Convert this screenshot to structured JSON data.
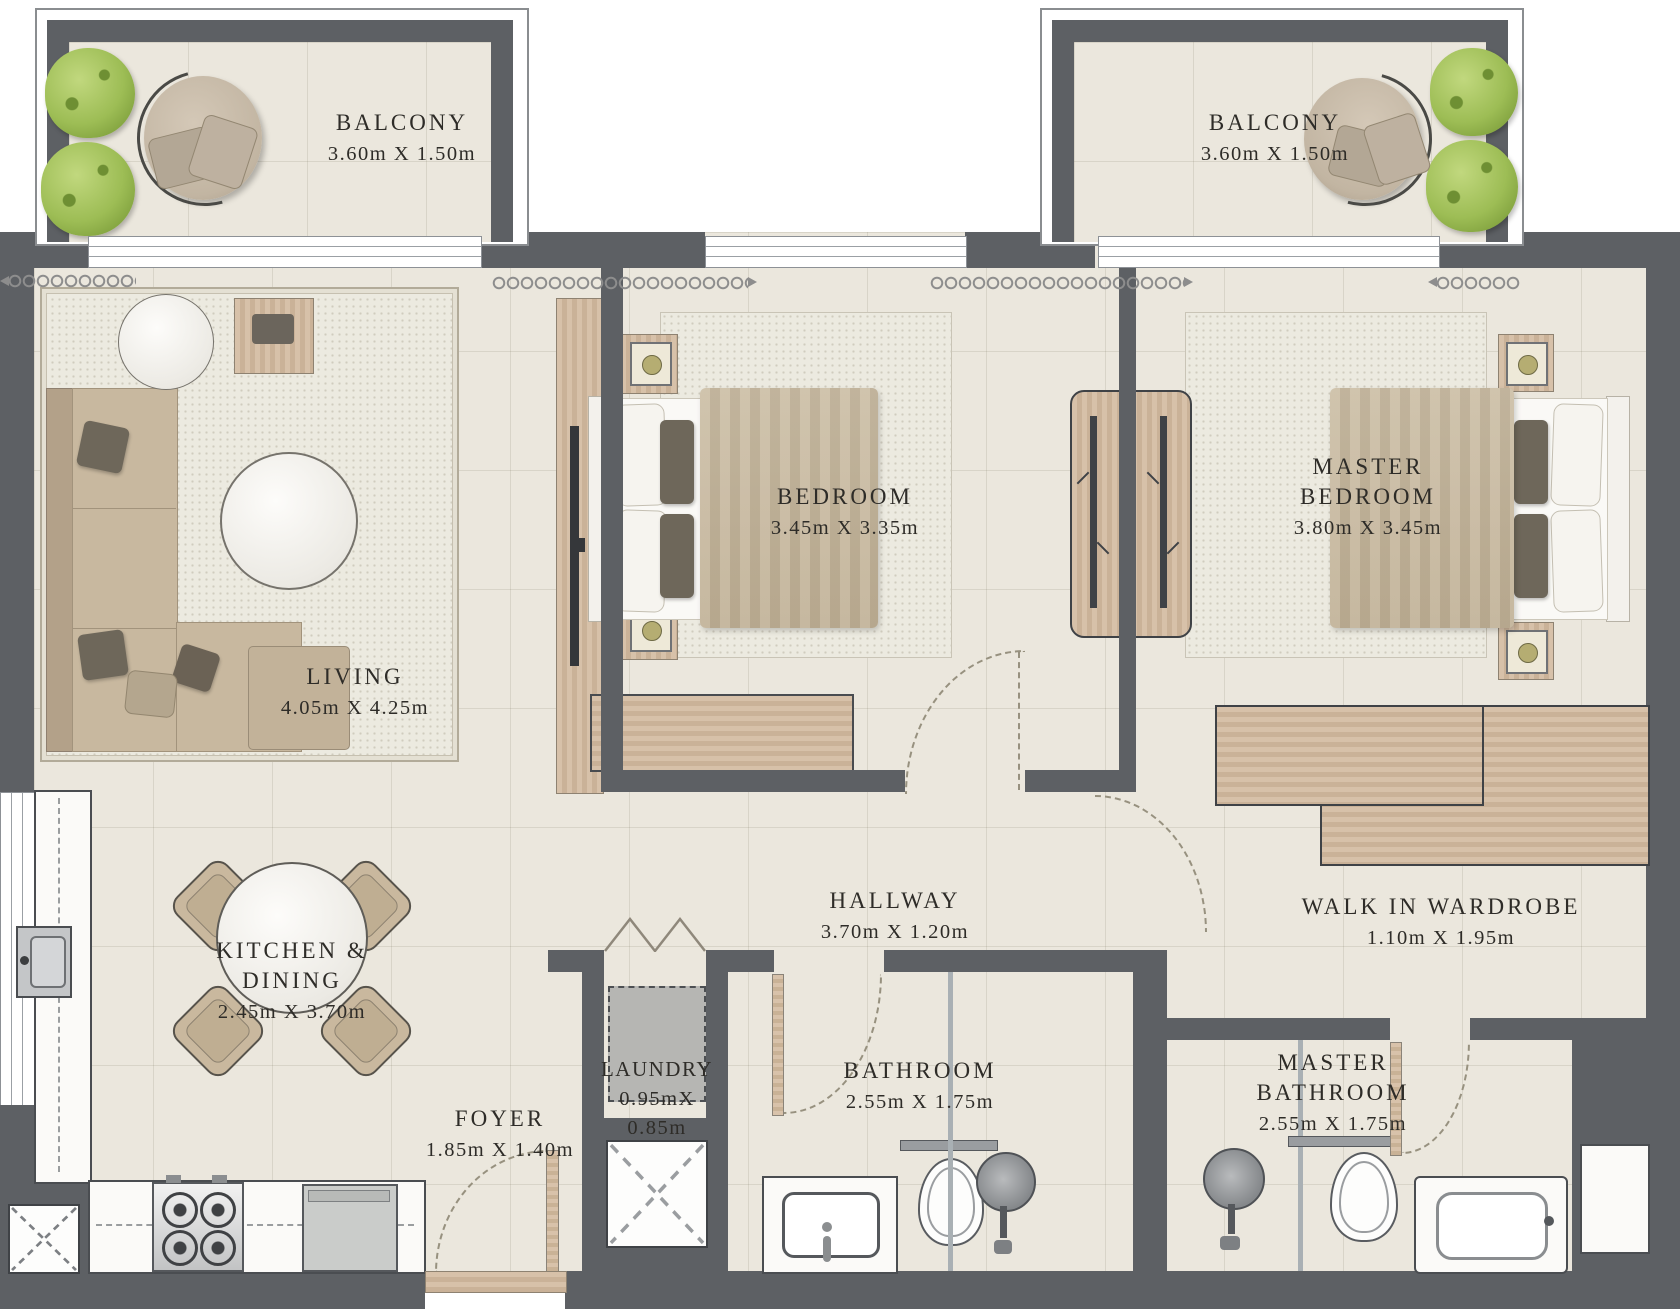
{
  "title": "apartment-floor-plan",
  "colors": {
    "wall": "#5d6064",
    "floor": "#ebe7dd",
    "wood": "#d3bda4",
    "plant_green": "#9dbd55",
    "text": "#2e2c28"
  },
  "rooms": {
    "balcony_left": {
      "name": "BALCONY",
      "dims": "3.60m X 1.50m"
    },
    "balcony_right": {
      "name": "BALCONY",
      "dims": "3.60m X 1.50m"
    },
    "living": {
      "name": "LIVING",
      "dims": "4.05m X 4.25m"
    },
    "bedroom": {
      "name": "BEDROOM",
      "dims": "3.45m X 3.35m"
    },
    "master_bedroom": {
      "name": "MASTER\nBEDROOM",
      "dims": "3.80m X 3.45m"
    },
    "kitchen_dining": {
      "name": "KITCHEN & DINING",
      "dims": "2.45m X 3.70m"
    },
    "hallway": {
      "name": "HALLWAY",
      "dims": "3.70m X 1.20m"
    },
    "walk_in_wardrobe": {
      "name": "WALK IN WARDROBE",
      "dims": "1.10m X 1.95m"
    },
    "laundry": {
      "name": "LAUNDRY",
      "dims": "0.95mX\n0.85m"
    },
    "bathroom": {
      "name": "BATHROOM",
      "dims": "2.55m X 1.75m"
    },
    "master_bathroom": {
      "name": "MASTER\nBATHROOM",
      "dims": "2.55m X 1.75m"
    },
    "foyer": {
      "name": "FOYER",
      "dims": "1.85m X 1.40m"
    }
  },
  "furniture_icons": [
    "plant",
    "lounge-chair",
    "sofa",
    "ottoman",
    "coffee-table",
    "side-table",
    "tv",
    "dining-table",
    "dining-chair",
    "stove",
    "dishwasher",
    "kitchen-sink",
    "cabinet",
    "washing-machine",
    "bathroom-sink",
    "toilet",
    "shower-head",
    "bathtub",
    "bed",
    "nightstand",
    "lamp",
    "wardrobe-rail",
    "bench",
    "door-swing",
    "window",
    "curtain"
  ]
}
